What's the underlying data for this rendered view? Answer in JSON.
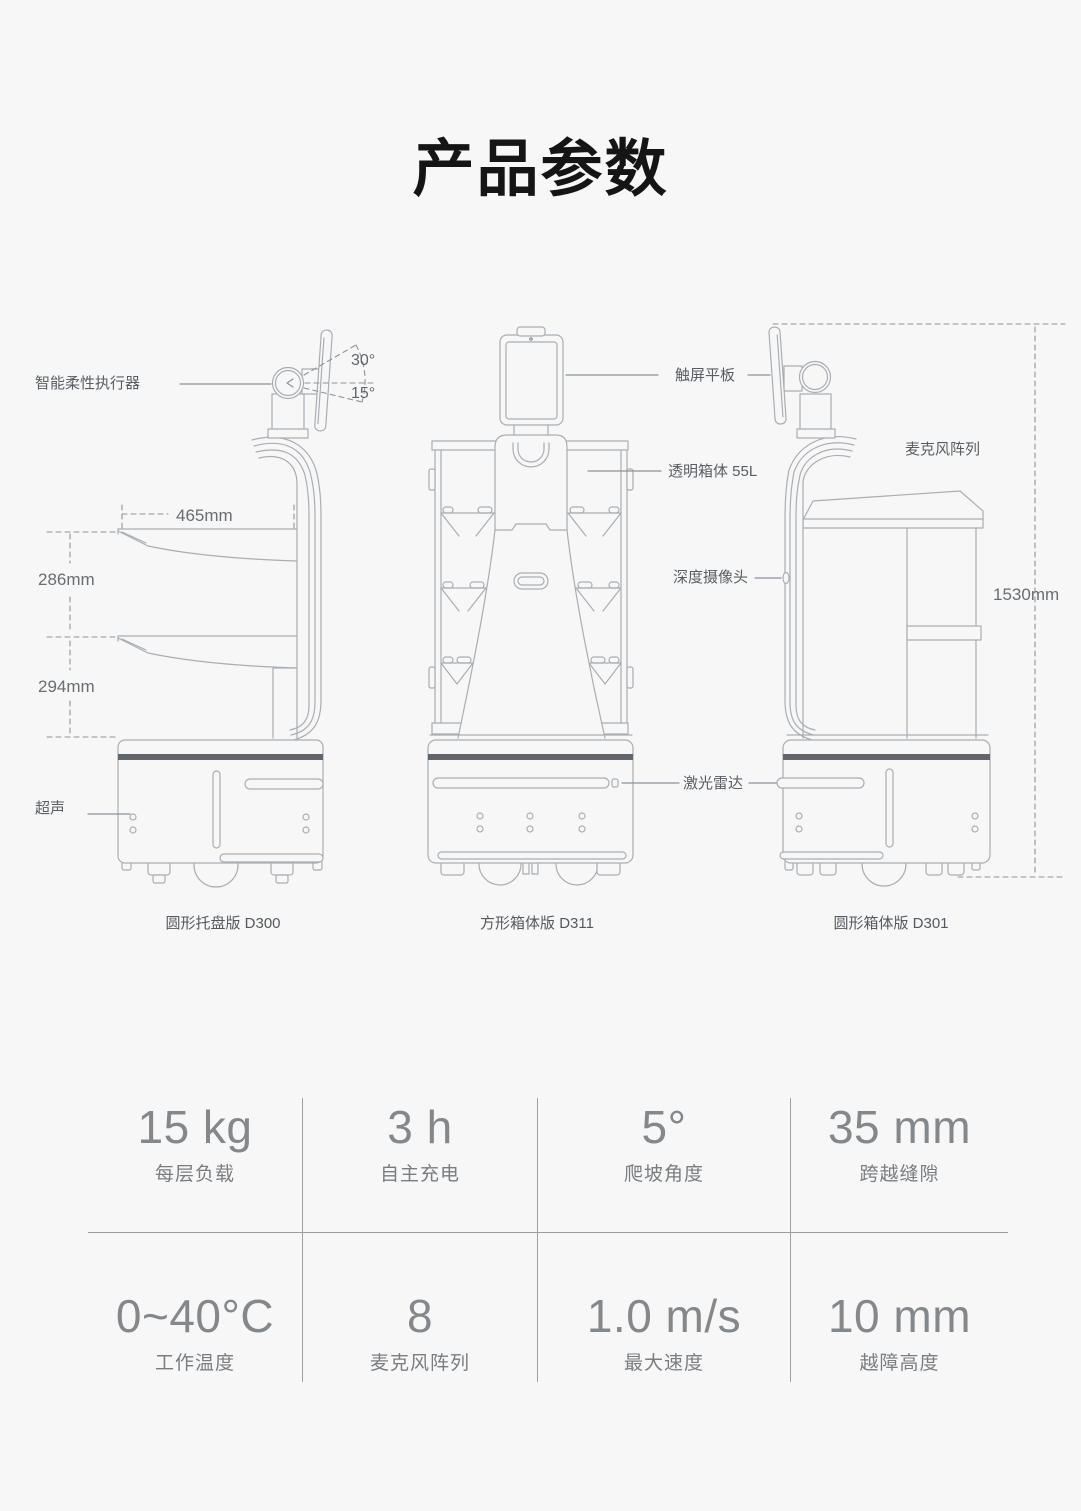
{
  "title": "产品参数",
  "diagram": {
    "robots": [
      {
        "caption": "圆形托盘版 D300"
      },
      {
        "caption": "方形箱体版 D311"
      },
      {
        "caption": "圆形箱体版 D301"
      }
    ],
    "labels": {
      "actuator": "智能柔性执行器",
      "ultrasound": "超声",
      "tablet": "触屏平板",
      "transparent_box": "透明箱体 55L",
      "depth_camera": "深度摄像头",
      "lidar": "激光雷达",
      "mic_array": "麦克风阵列"
    },
    "dimensions": {
      "tray_width": "465mm",
      "tray_gap_upper": "286mm",
      "tray_gap_lower": "294mm",
      "total_height": "1530mm",
      "angle_up": "30°",
      "angle_down": "15°"
    }
  },
  "specs": [
    {
      "value": "15 kg",
      "label": "每层负载"
    },
    {
      "value": "3 h",
      "label": "自主充电"
    },
    {
      "value": "5°",
      "label": "爬坡角度"
    },
    {
      "value": "35 mm",
      "label": "跨越缝隙"
    },
    {
      "value": "0~40°C",
      "label": "工作温度"
    },
    {
      "value": "8",
      "label": "麦克风阵列"
    },
    {
      "value": "1.0 m/s",
      "label": "最大速度"
    },
    {
      "value": "10 mm",
      "label": "越障高度"
    }
  ]
}
